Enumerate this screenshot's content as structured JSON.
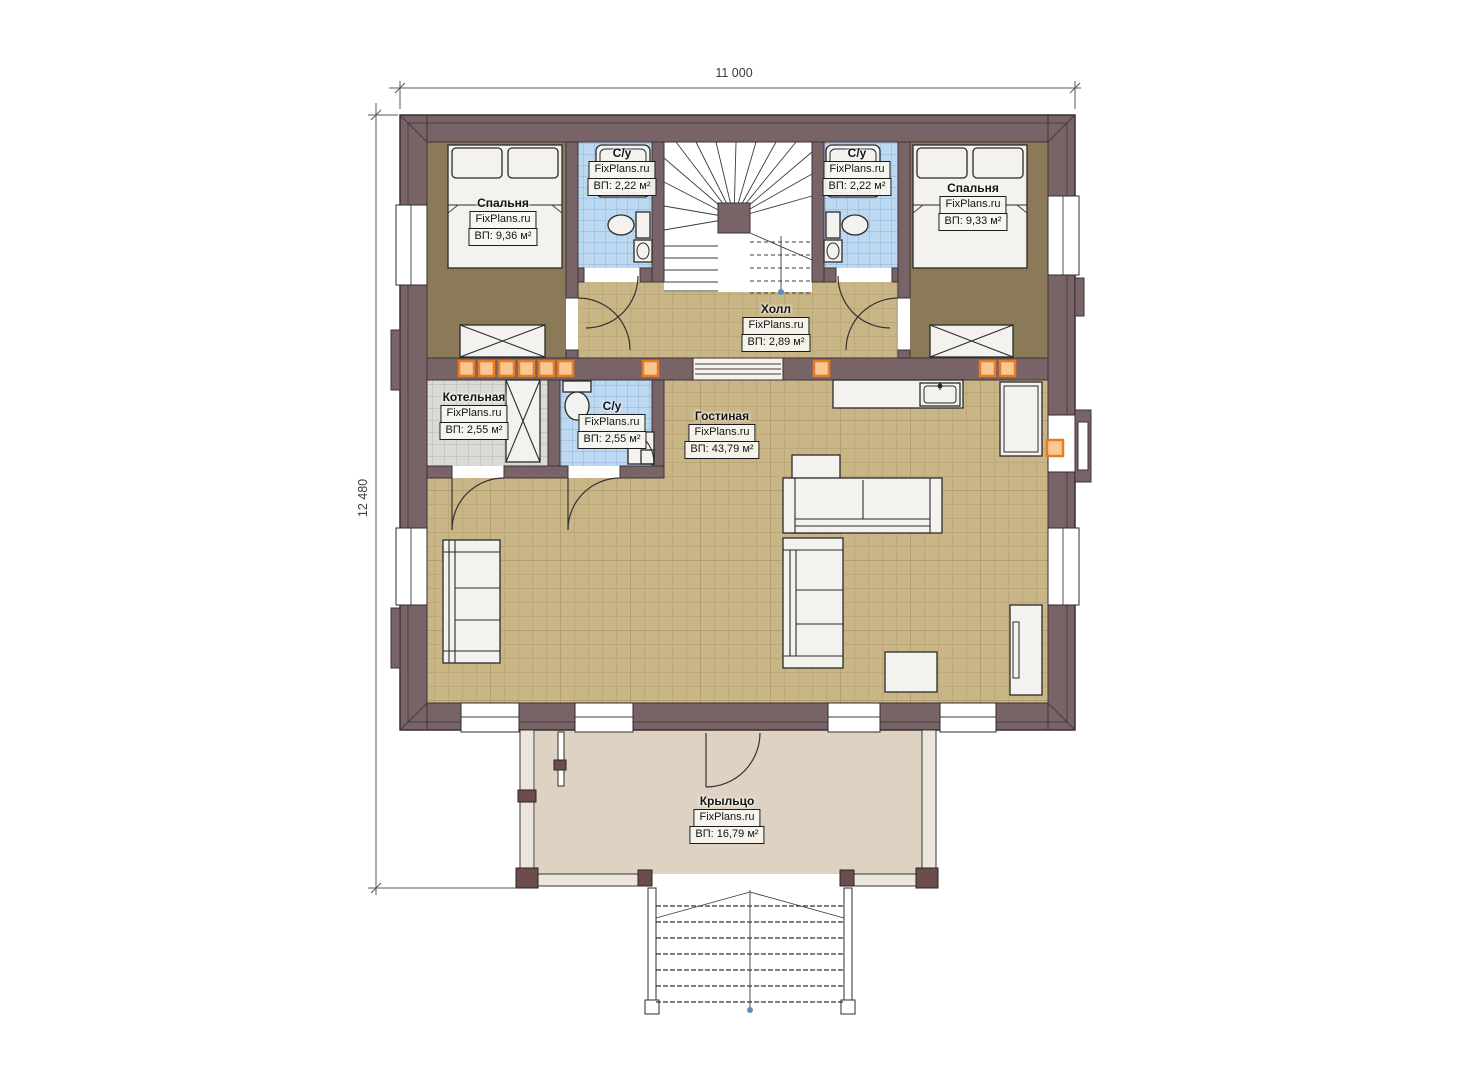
{
  "brand": "FixPlans.ru",
  "dimensions": {
    "width": "11 000",
    "height": "12 480"
  },
  "rooms": {
    "bedroom_left": {
      "name": "Спальня",
      "brand": "FixPlans.ru",
      "area": "ВП: 9,36 м²"
    },
    "bath_up_left": {
      "name": "С/у",
      "brand": "FixPlans.ru",
      "area": "ВП: 2,22 м²"
    },
    "bath_up_right": {
      "name": "С/у",
      "brand": "FixPlans.ru",
      "area": "ВП: 2,22 м²"
    },
    "bedroom_right": {
      "name": "Спальня",
      "brand": "FixPlans.ru",
      "area": "ВП: 9,33 м²"
    },
    "hall": {
      "name": "Холл",
      "brand": "FixPlans.ru",
      "area": "ВП: 2,89 м²"
    },
    "boiler": {
      "name": "Котельная",
      "brand": "FixPlans.ru",
      "area": "ВП: 2,55 м²"
    },
    "bath_down": {
      "name": "С/у",
      "brand": "FixPlans.ru",
      "area": "ВП: 2,55 м²"
    },
    "living": {
      "name": "Гостиная",
      "brand": "FixPlans.ru",
      "area": "ВП: 43,79 м²"
    },
    "porch": {
      "name": "Крыльцо",
      "brand": "FixPlans.ru",
      "area": "ВП: 16,79 м²"
    }
  },
  "colors": {
    "wall": "#786367",
    "wall_line": "#3e3236",
    "floor_bedroom": "#8b7a58",
    "floor_tile": "#c9b687",
    "floor_bath": "#bdd8f1",
    "floor_boiler": "#dbdbd5",
    "floor_porch": "#ded3c3",
    "marker_orange": "#e87b28"
  }
}
